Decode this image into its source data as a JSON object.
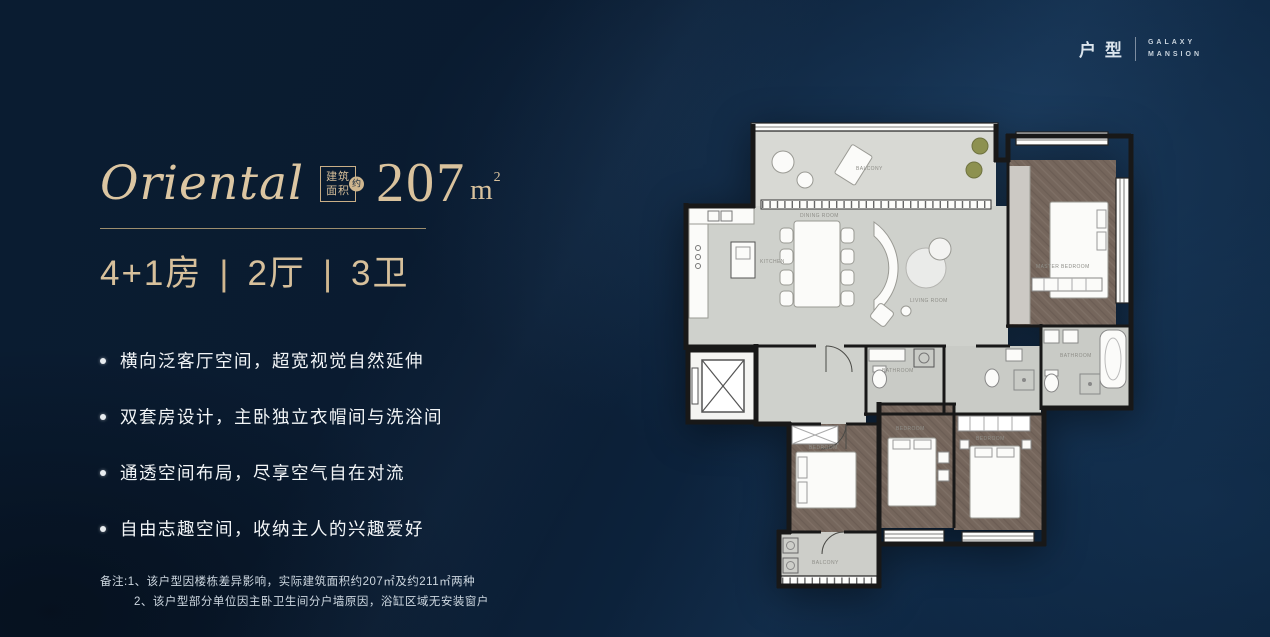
{
  "brand": {
    "category": "户型",
    "name_top": "GALAXY",
    "name_bottom": "MANSION"
  },
  "header": {
    "title": "Oriental",
    "badge_line1": "建筑",
    "badge_line2": "面积",
    "badge_circle": "约",
    "area_value": "207",
    "area_unit": "m",
    "area_exp": "2"
  },
  "specs": {
    "rooms": "4+1房",
    "divider": "|",
    "halls": "2厅",
    "baths": "3卫"
  },
  "features": {
    "items": [
      "横向泛客厅空间，超宽视觉自然延伸",
      "双套房设计，主卧独立衣帽间与洗浴间",
      "通透空间布局，尽享空气自在对流",
      "自由志趣空间，收纳主人的兴趣爱好"
    ]
  },
  "notes": {
    "line1": "备注:1、该户型因楼栋差异影响，实际建筑面积约207㎡及约211㎡两种",
    "line2": "2、该户型部分单位因主卧卫生间分户墙原因，浴缸区域无安装窗户"
  },
  "floorplan": {
    "labels": {
      "balcony": "BALCONY",
      "dining": "DINING ROOM",
      "kitchen": "KITCHEN",
      "living": "LIVING ROOM",
      "master_bedroom": "MASTER BEDROOM",
      "master_bath": "BATHROOM",
      "bath2": "BATHROOM",
      "bedroom1": "BEDROOM",
      "bedroom2": "BEDROOM",
      "bedroom3": "BEDROOM",
      "balcony2": "BALCONY"
    }
  },
  "colors": {
    "accent": "#d5bd98",
    "background": "#0a1b31",
    "plan_dark_floor": "#75665c",
    "plan_light_floor": "#cfd1cc"
  }
}
